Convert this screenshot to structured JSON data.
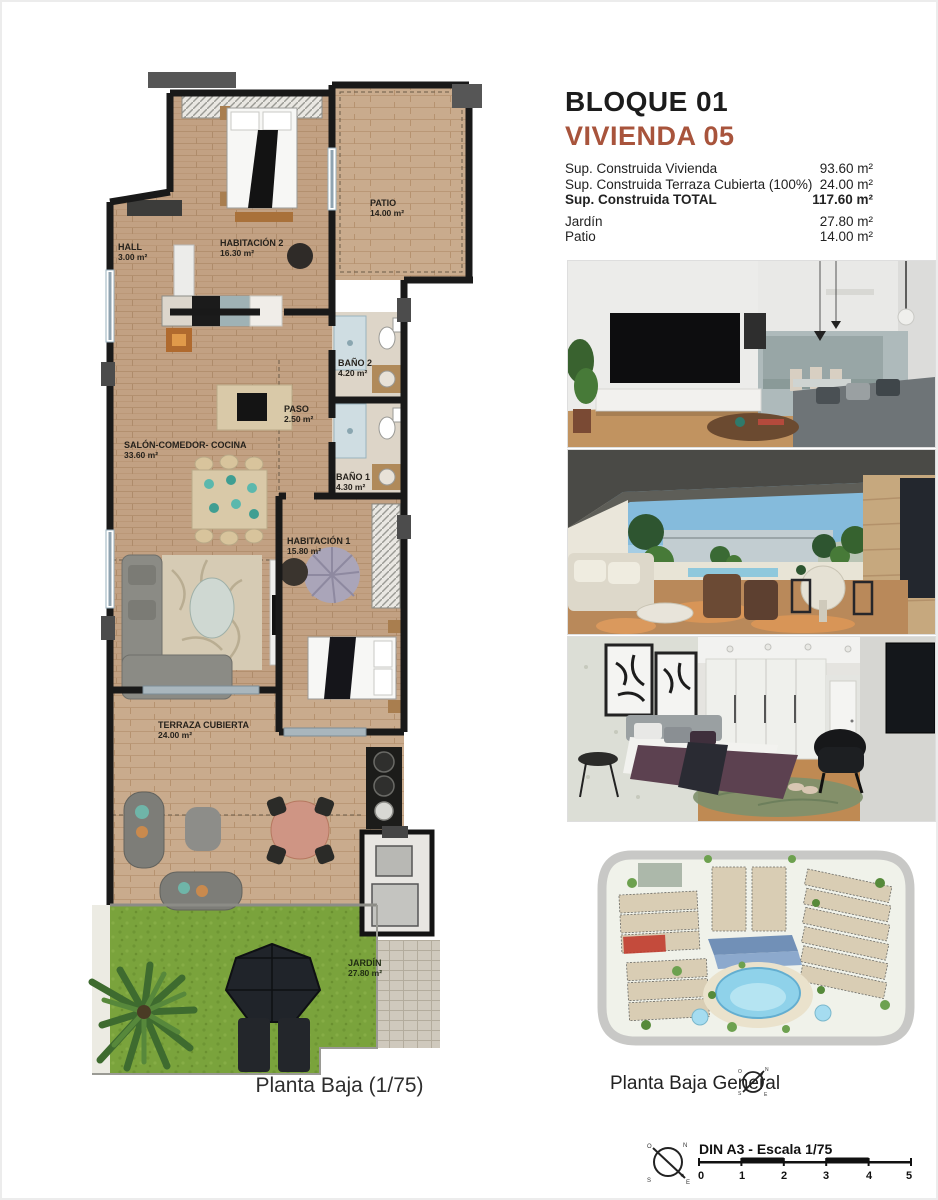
{
  "page": {
    "background": "#ffffff",
    "frame": "#ececec"
  },
  "header": {
    "block": "BLOQUE 01",
    "unit": "VIVIENDA 05",
    "accent_color": "#a8543c"
  },
  "areas": {
    "rows": [
      {
        "label": "Sup. Construida Vivienda",
        "value": "93.60 m²"
      },
      {
        "label": "Sup. Construida Terraza Cubierta (100%)",
        "value": "24.00 m²"
      },
      {
        "label": "Sup. Construida TOTAL",
        "value": "117.60 m²"
      },
      {
        "label": "Jardín",
        "value": "27.80 m²"
      },
      {
        "label": "Patio",
        "value": "14.00 m²"
      }
    ]
  },
  "floor_plan": {
    "caption": "Planta Baja (1/75)",
    "rooms": [
      {
        "name": "HALL",
        "area": "3.00 m²"
      },
      {
        "name": "HABITACIÓN 2",
        "area": "16.30 m²"
      },
      {
        "name": "PATIO",
        "area": "14.00 m²"
      },
      {
        "name": "BAÑO 2",
        "area": "4.20 m²"
      },
      {
        "name": "PASO",
        "area": "2.50 m²"
      },
      {
        "name": "SALÓN-COMEDOR- COCINA",
        "area": "33.60 m²"
      },
      {
        "name": "BAÑO 1",
        "area": "4.30 m²"
      },
      {
        "name": "HABITACIÓN 1",
        "area": "15.80 m²"
      },
      {
        "name": "TERRAZA CUBIERTA",
        "area": "24.00 m²"
      },
      {
        "name": "JARDÍN",
        "area": "27.80 m²"
      }
    ],
    "colors": {
      "wall": "#191919",
      "wood": "#c2a183",
      "grass": "#7aa33c",
      "bath": "#ddd5c8",
      "highlight": "#c0392b"
    }
  },
  "photos": [
    {
      "name": "salon-comedor-render"
    },
    {
      "name": "terraza-render"
    },
    {
      "name": "dormitorio-render"
    }
  ],
  "site_plan": {
    "caption": "Planta Baja General"
  },
  "scale_bar": {
    "label": "DIN A3 - Escala 1/75",
    "ticks": [
      "0",
      "1",
      "2",
      "3",
      "4",
      "5"
    ]
  },
  "compass": {
    "n": "N",
    "s": "S",
    "e": "E",
    "o": "O"
  }
}
